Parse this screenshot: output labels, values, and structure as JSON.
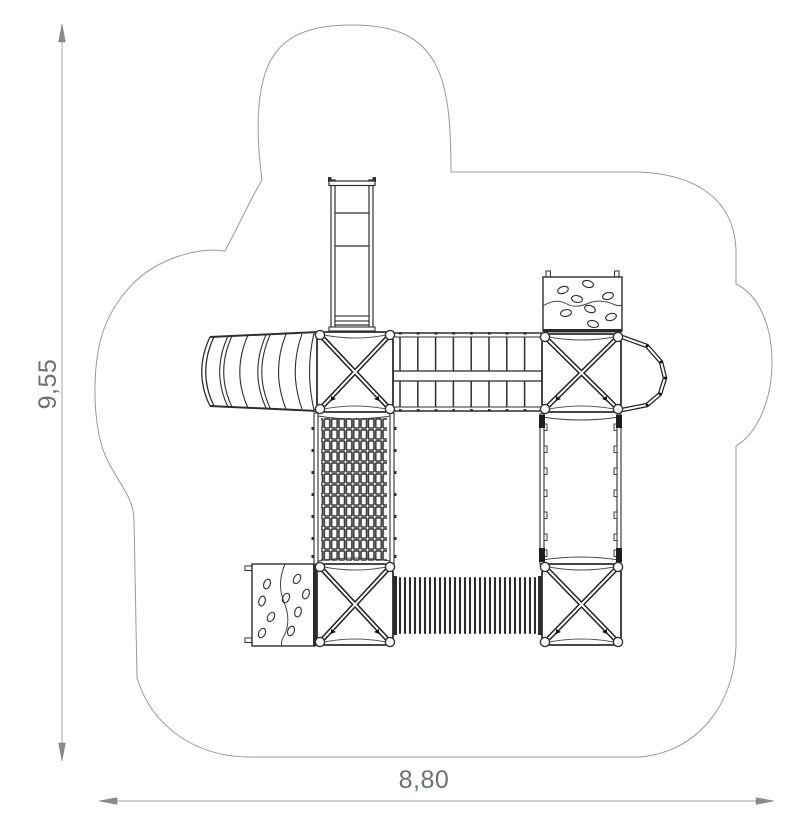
{
  "page": {
    "title": "Playground structure plan view",
    "background_color": "#ffffff"
  },
  "dimensions": {
    "height_label": "9,55",
    "width_label": "8,80",
    "text_color": "#6b7177",
    "line_color": "#a3a3a3",
    "arrow_color": "#8a8a8a"
  },
  "drawing": {
    "safety_zone_outline_color": "#9a9a9a",
    "equipment_line_color": "#2e2e2e",
    "components": [
      {
        "name": "access-ladder",
        "position": "top-center"
      },
      {
        "name": "wave-slide",
        "position": "left"
      },
      {
        "name": "platform-tower-nw",
        "position": "center-left-upper"
      },
      {
        "name": "rung-bridge",
        "position": "center-upper"
      },
      {
        "name": "rock-climbing-wall-north",
        "position": "upper-right"
      },
      {
        "name": "platform-tower-ne",
        "position": "right-upper"
      },
      {
        "name": "lookout-balcony",
        "position": "far-right-upper"
      },
      {
        "name": "climbing-net",
        "position": "center-left-middle"
      },
      {
        "name": "rail-walkway",
        "position": "right-middle"
      },
      {
        "name": "rock-climbing-wall-west",
        "position": "lower-left"
      },
      {
        "name": "platform-tower-sw",
        "position": "center-left-lower"
      },
      {
        "name": "crawl-tunnel",
        "position": "center-lower"
      },
      {
        "name": "platform-tower-se",
        "position": "right-lower"
      }
    ]
  }
}
